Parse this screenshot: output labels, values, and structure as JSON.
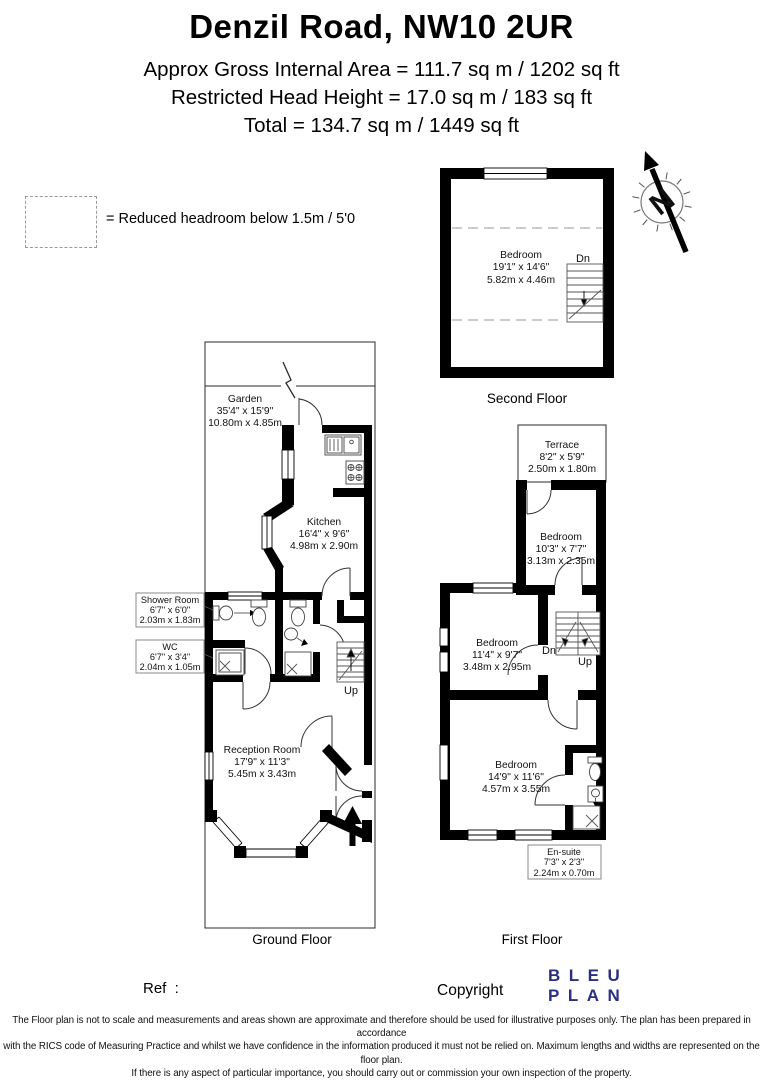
{
  "header": {
    "title": "Denzil Road, NW10 2UR",
    "area_line": "Approx Gross Internal Area = 111.7 sq m / 1202 sq ft",
    "head_height_line": "Restricted Head Height = 17.0 sq m / 183 sq ft",
    "total_line": "Total = 134.7 sq m / 1449 sq ft"
  },
  "legend": {
    "label": "= Reduced headroom below 1.5m / 5'0"
  },
  "compass": {
    "north": "N"
  },
  "floors": {
    "second": {
      "label": "Second Floor",
      "bedroom": {
        "name": "Bedroom",
        "imperial": "19'1\" x 14'6\"",
        "metric": "5.82m x 4.46m"
      },
      "dn": "Dn"
    },
    "first": {
      "label": "First Floor",
      "terrace": {
        "name": "Terrace",
        "imperial": "8'2\" x 5'9\"",
        "metric": "2.50m x 1.80m"
      },
      "bedroom_top": {
        "name": "Bedroom",
        "imperial": "10'3\" x 7'7\"",
        "metric": "3.13m x 2.35m"
      },
      "bedroom_mid": {
        "name": "Bedroom",
        "imperial": "11'4\" x 9'7\"",
        "metric": "3.48m x 2.95m"
      },
      "bedroom_bottom": {
        "name": "Bedroom",
        "imperial": "14'9\" x 11'6\"",
        "metric": "4.57m x 3.55m"
      },
      "ensuite": {
        "name": "En-suite",
        "imperial": "7'3\" x 2'3\"",
        "metric": "2.24m x 0.70m"
      },
      "dn": "Dn",
      "up": "Up"
    },
    "ground": {
      "label": "Ground Floor",
      "garden": {
        "name": "Garden",
        "imperial": "35'4\" x 15'9\"",
        "metric": "10.80m x 4.85m"
      },
      "kitchen": {
        "name": "Kitchen",
        "imperial": "16'4\" x 9'6\"",
        "metric": "4.98m x 2.90m"
      },
      "shower_room": {
        "name": "Shower Room",
        "imperial": "6'7\" x 6'0\"",
        "metric": "2.03m x 1.83m"
      },
      "wc": {
        "name": "WC",
        "imperial": "6'7\" x 3'4\"",
        "metric": "2.04m x 1.05m"
      },
      "reception": {
        "name": "Reception Room",
        "imperial": "17'9\" x 11'3\"",
        "metric": "5.45m x 3.43m"
      },
      "up": "Up"
    }
  },
  "footer": {
    "ref_label": "Ref  :",
    "copyright_label": "Copyright",
    "logo": {
      "line1": "BLEU",
      "line2": "PLAN"
    },
    "disclaimer": [
      "The Floor plan is not to scale and measurements and areas shown are approximate and therefore should be used for illustrative purposes only. The plan has been prepared in accordance",
      "with the RICS code of Measuring Practice and whilst we have confidence in the information produced it must not be relied on. Maximum lengths and widths are represented on the floor plan.",
      "If there is any aspect of particular importance, you should carry out or commission your own inspection of the property.",
      "Copyright @ BleuPlan"
    ]
  },
  "colors": {
    "logo_navy": "#2c2e80",
    "wall_black": "#000000"
  }
}
